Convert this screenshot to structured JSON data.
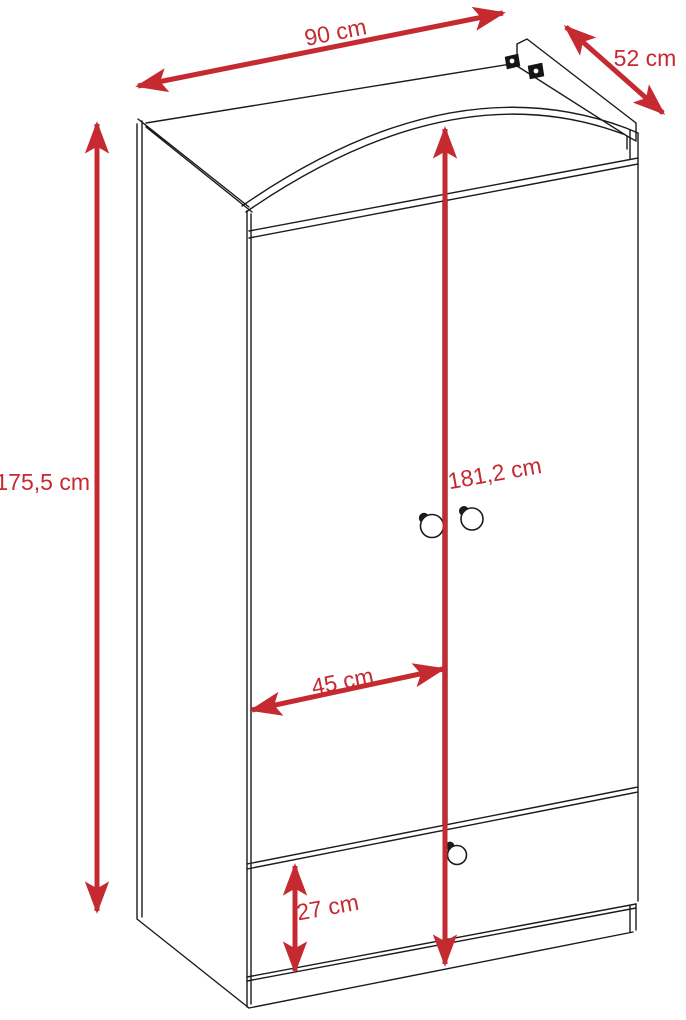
{
  "diagram": {
    "subject": "two-door wardrobe with bottom drawer, arched top crown and rear top rail",
    "view": "isometric line drawing with red dimension arrows",
    "unit": "cm",
    "labels": {
      "width": "90 cm",
      "depth": "52 cm",
      "side_height": "175,5 cm",
      "total_height": "181,2 cm",
      "door_width": "45 cm",
      "drawer_height": "27 cm"
    },
    "values_cm": {
      "width": 90,
      "depth": 52,
      "side_height": 175.5,
      "total_height": 181.2,
      "door_width": 45,
      "drawer_height": 27
    },
    "colors": {
      "dimension_accent": "#c42a30",
      "outline": "#1b1b1b",
      "background": "#ffffff"
    }
  }
}
